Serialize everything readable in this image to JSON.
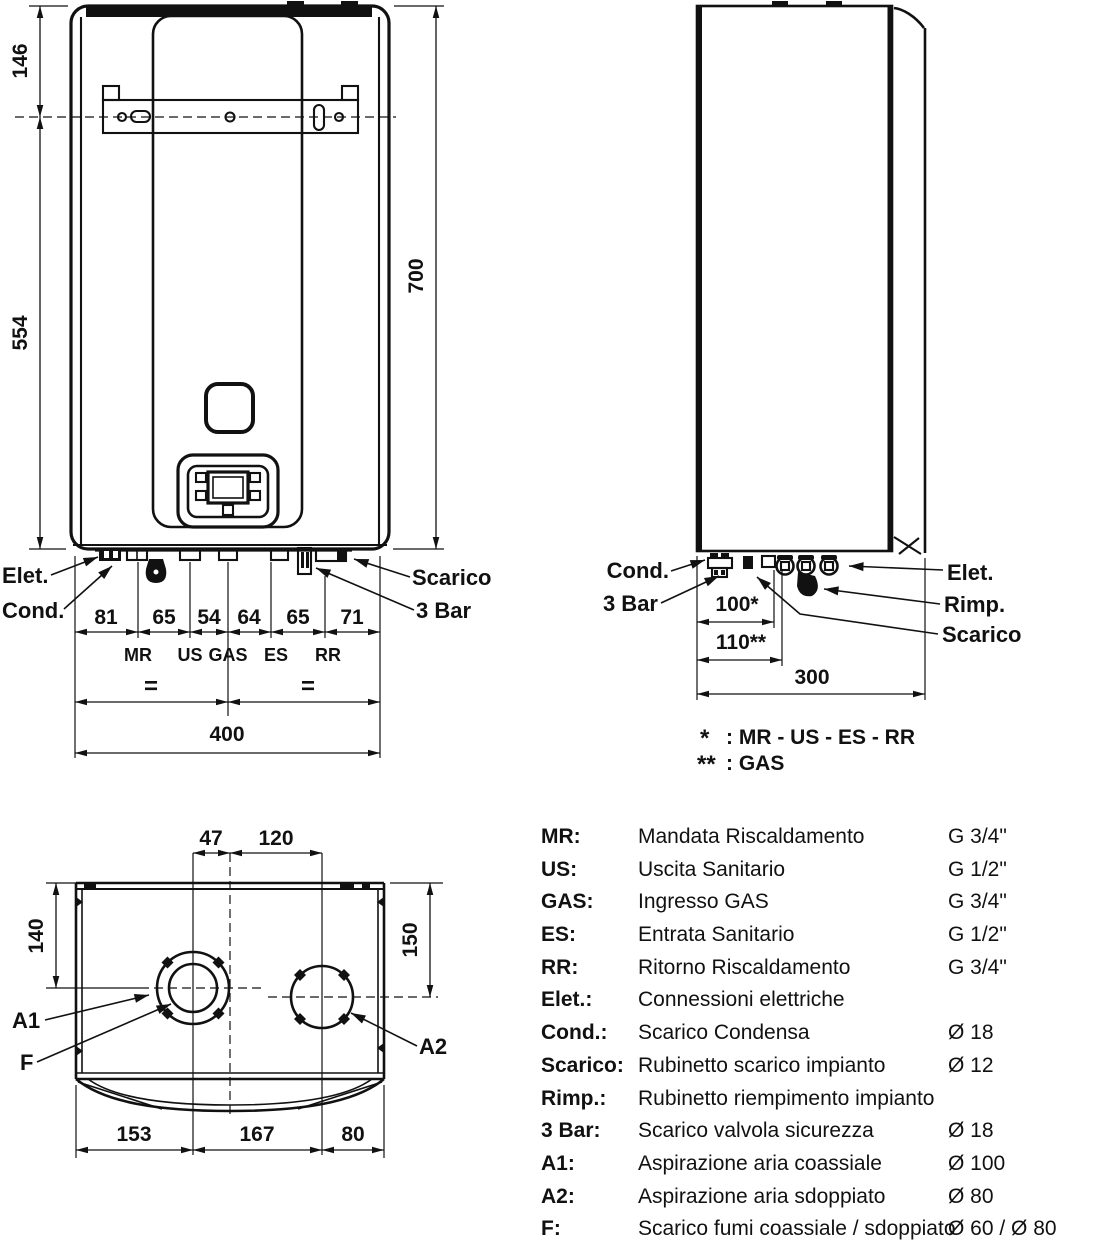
{
  "front": {
    "h1": "146",
    "h2": "554",
    "h_total": "700",
    "chain": [
      "81",
      "65",
      "54",
      "64",
      "65",
      "71"
    ],
    "ports": [
      "MR",
      "US",
      "GAS",
      "ES",
      "RR"
    ],
    "equals": [
      "=",
      "="
    ],
    "w_total": "400",
    "elet": "Elet.",
    "cond": "Cond.",
    "scarico": "Scarico",
    "bar3": "3 Bar"
  },
  "side": {
    "cond": "Cond.",
    "bar3": "3 Bar",
    "elet": "Elet.",
    "rimp": "Rimp.",
    "scarico": "Scarico",
    "d_ports": "100*",
    "d_gas": "110**",
    "d_total": "300",
    "note1_mark": "*",
    "note1_text": ": MR - US - ES - RR",
    "note2_mark": "**",
    "note2_text": ": GAS"
  },
  "top": {
    "d1": "47",
    "d2": "120",
    "d_left": "140",
    "d_right": "150",
    "chain": [
      "153",
      "167",
      "80"
    ],
    "a1": "A1",
    "f": "F",
    "a2": "A2"
  },
  "legend": {
    "rows": [
      {
        "key": "MR:",
        "desc": "Mandata Riscaldamento",
        "size": "G 3/4\""
      },
      {
        "key": "US:",
        "desc": "Uscita Sanitario",
        "size": "G 1/2\""
      },
      {
        "key": "GAS:",
        "desc": "Ingresso GAS",
        "size": "G 3/4\""
      },
      {
        "key": "ES:",
        "desc": "Entrata Sanitario",
        "size": "G 1/2\""
      },
      {
        "key": "RR:",
        "desc": "Ritorno Riscaldamento",
        "size": "G 3/4\""
      },
      {
        "key": "Elet.:",
        "desc": "Connessioni elettriche",
        "size": ""
      },
      {
        "key": "Cond.:",
        "desc": "Scarico Condensa",
        "size": "Ø 18"
      },
      {
        "key": "Scarico:",
        "desc": "Rubinetto scarico impianto",
        "size": "Ø 12"
      },
      {
        "key": "Rimp.:",
        "desc": "Rubinetto riempimento impianto",
        "size": ""
      },
      {
        "key": "3 Bar:",
        "desc": "Scarico valvola sicurezza",
        "size": "Ø 18"
      },
      {
        "key": "A1:",
        "desc": "Aspirazione aria coassiale",
        "size": "Ø 100"
      },
      {
        "key": "A2:",
        "desc": "Aspirazione aria sdoppiato",
        "size": "Ø 80"
      },
      {
        "key": "F:",
        "desc": "Scarico fumi coassiale / sdoppiato",
        "size": "Ø 60 / Ø 80"
      }
    ]
  },
  "colors": {
    "line": "#111111",
    "background": "#ffffff"
  }
}
